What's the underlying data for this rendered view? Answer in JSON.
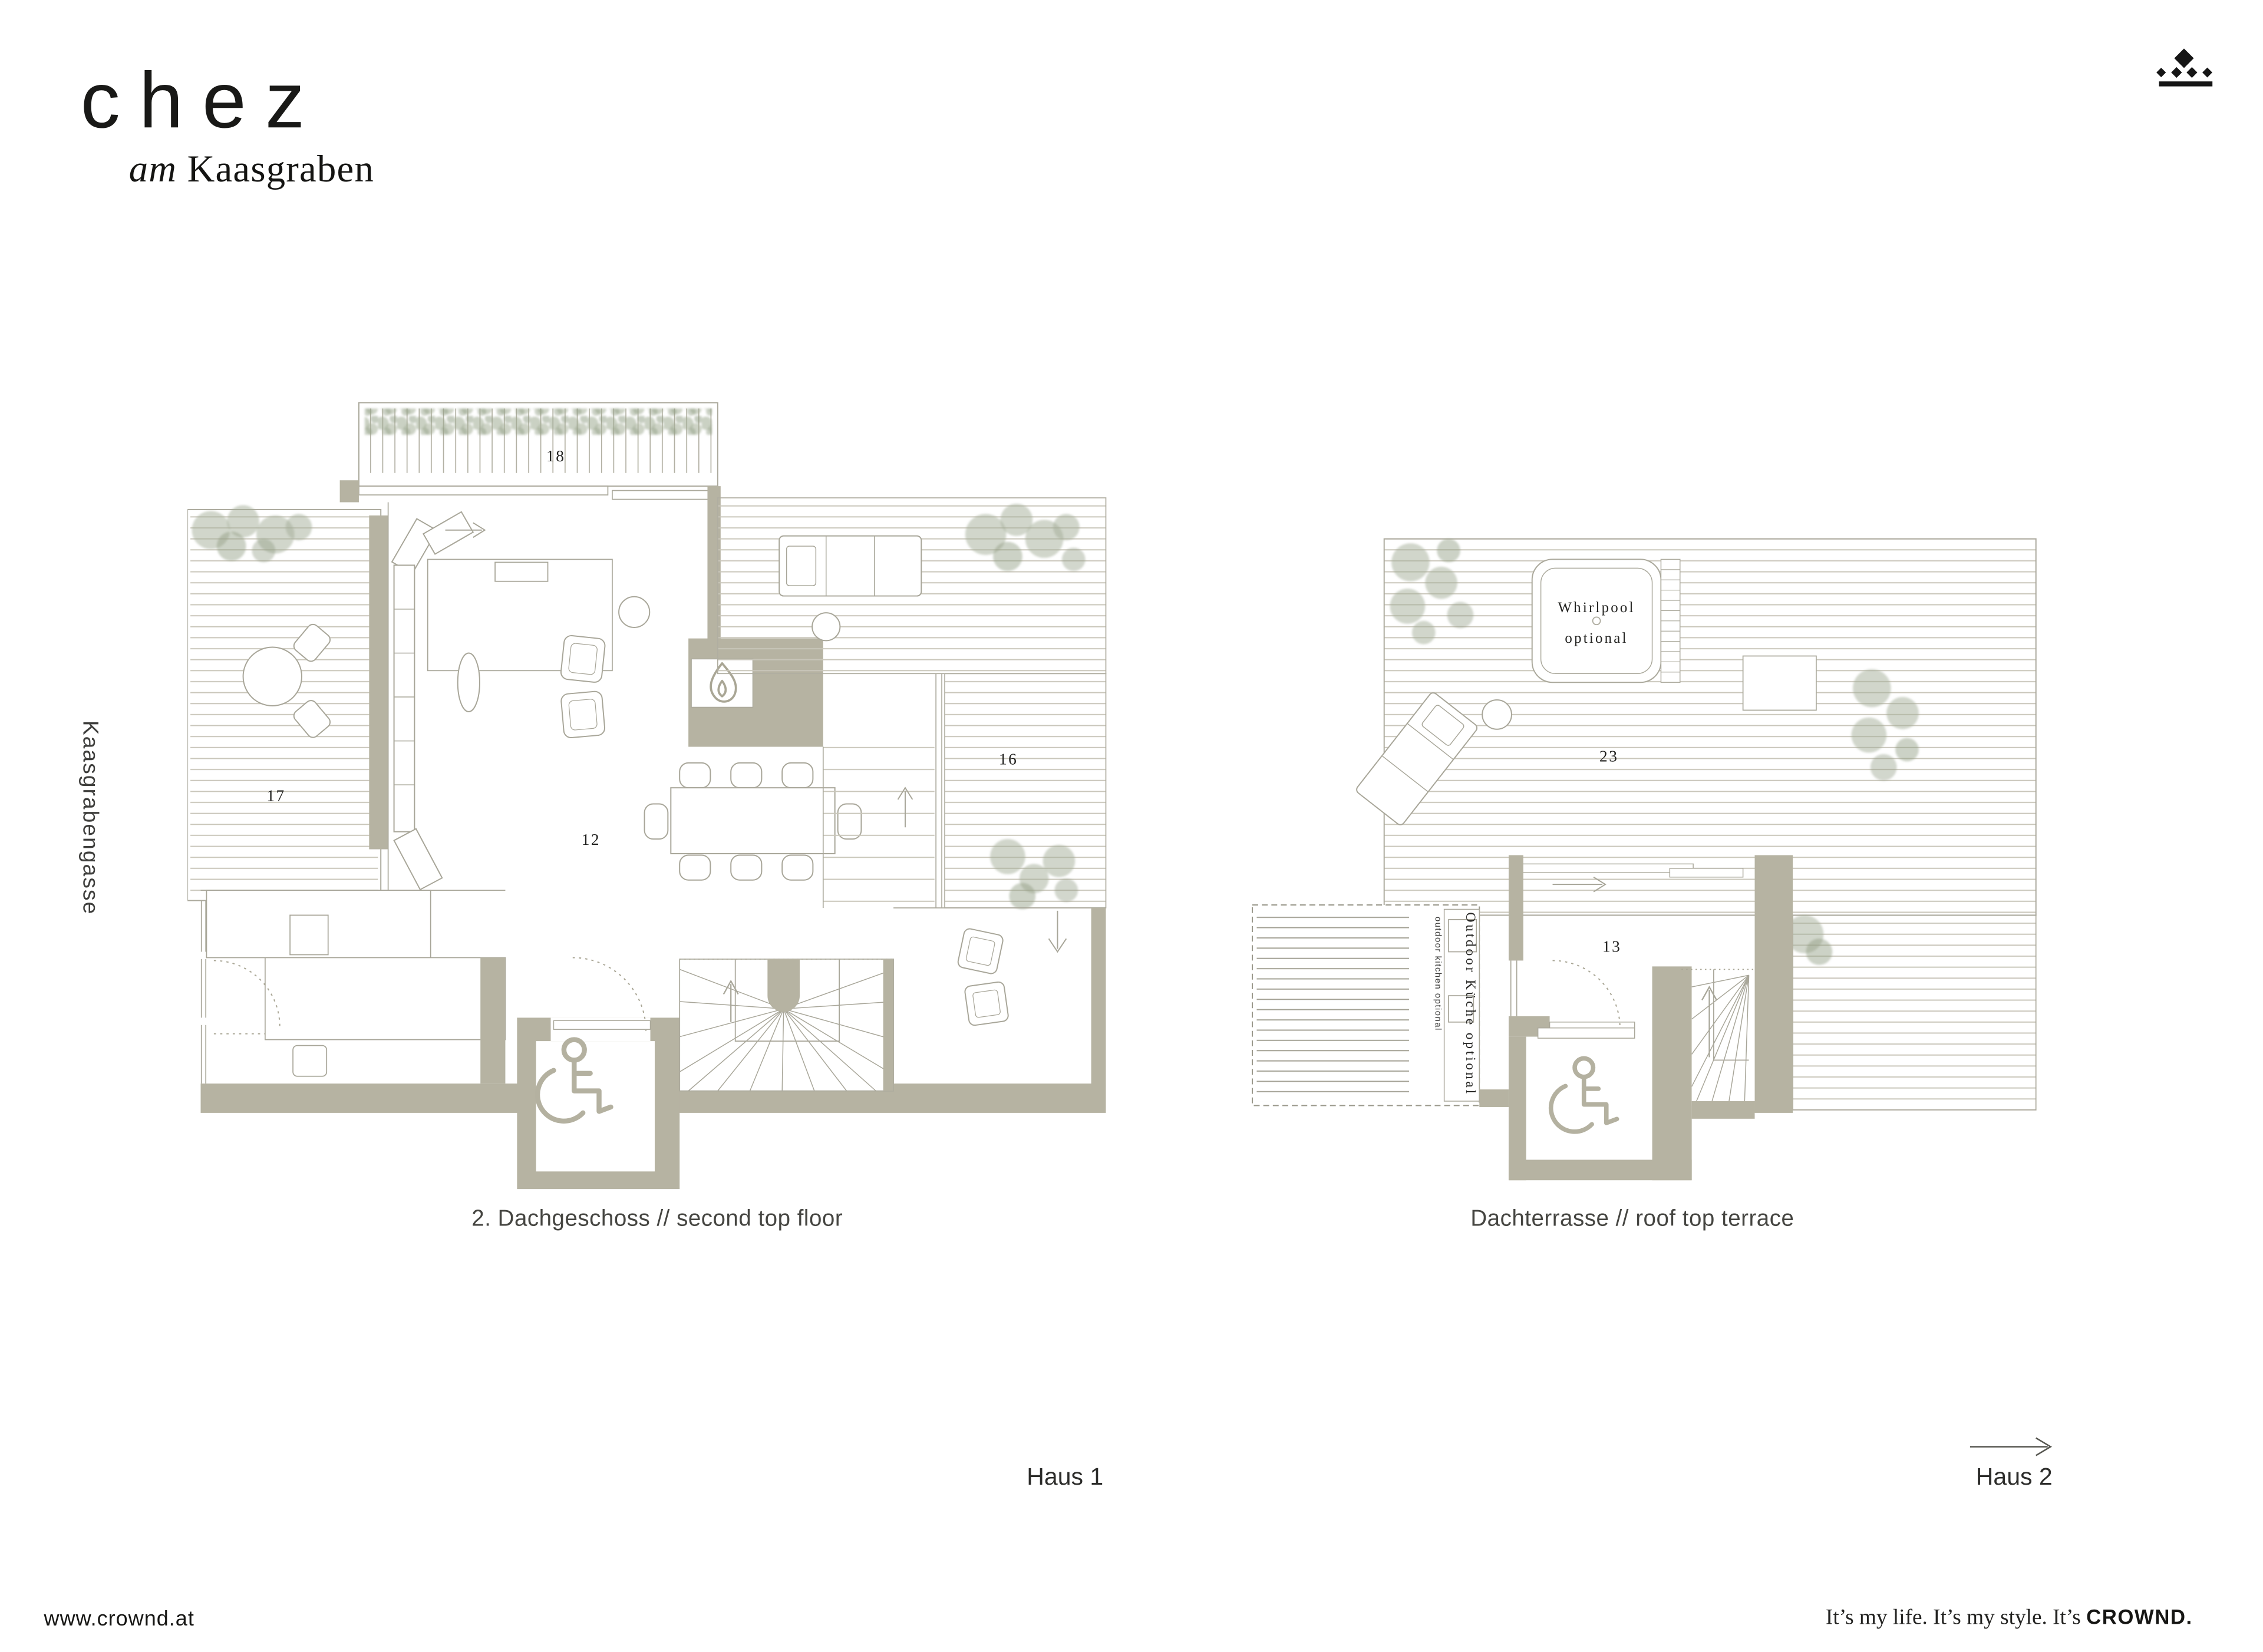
{
  "header": {
    "logo_main": "chez",
    "logo_sub_italic": "am",
    "logo_sub_rest": "Kaasgraben",
    "brand_icon": "crown-diamonds-icon"
  },
  "street_label": "Kaasgrabengasse",
  "plan1": {
    "caption": "2. Dachgeschoss // second top floor",
    "house_label": "Haus 1",
    "numbers": {
      "pergola": "18",
      "terrace_left": "17",
      "living": "12",
      "terrace_right": "16"
    }
  },
  "plan2": {
    "caption": "Dachterrasse // roof top terrace",
    "house_label": "Haus 2",
    "numbers": {
      "terrace": "23",
      "room": "13"
    },
    "whirlpool_line1": "Whirlpool",
    "whirlpool_line2": "optional",
    "outdoor_kitchen_de": "Outdoor Küche optional",
    "outdoor_kitchen_en": "outdoor kitchen optional"
  },
  "footer": {
    "website": "www.crownd.at",
    "tagline_prefix": "It’s my life. It’s my style. It’s ",
    "tagline_brand": "CROWND."
  },
  "colors": {
    "wall": "#b6b3a2",
    "line": "#a5a396",
    "deck_line": "#c9c6ba",
    "green": "#a3ae97",
    "text": "#1d1d1b"
  }
}
